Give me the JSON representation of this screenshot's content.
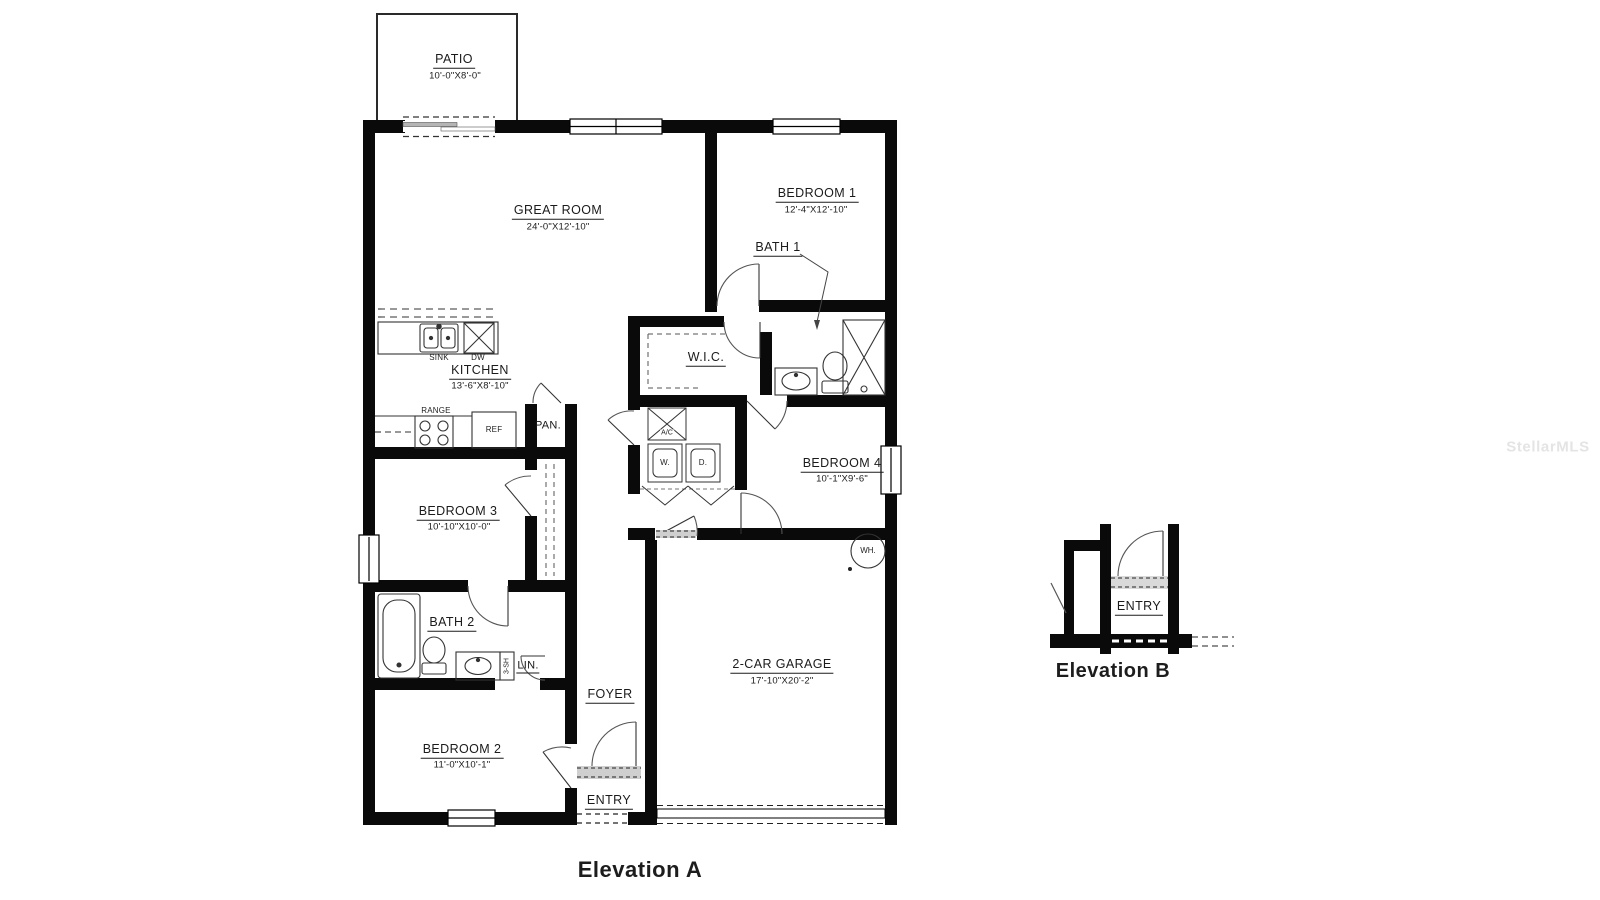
{
  "plan": {
    "watermark": "StellarMLS",
    "titles": {
      "elevation_a": "Elevation A",
      "elevation_b": "Elevation B"
    },
    "rooms": {
      "patio": {
        "name": "PATIO",
        "dims": "10'-0\"X8'-0\""
      },
      "great_room": {
        "name": "GREAT ROOM",
        "dims": "24'-0\"X12'-10\""
      },
      "bedroom1": {
        "name": "BEDROOM 1",
        "dims": "12'-4\"X12'-10\""
      },
      "bath1": {
        "name": "BATH 1"
      },
      "kitchen": {
        "name": "KITCHEN",
        "dims": "13'-6\"X8'-10\""
      },
      "wic": {
        "name": "W.I.C."
      },
      "bedroom4": {
        "name": "BEDROOM 4",
        "dims": "10'-1\"X9'-6\""
      },
      "bedroom3": {
        "name": "BEDROOM 3",
        "dims": "10'-10\"X10'-0\""
      },
      "bath2": {
        "name": "BATH 2"
      },
      "bedroom2": {
        "name": "BEDROOM 2",
        "dims": "11'-0\"X10'-1\""
      },
      "foyer": {
        "name": "FOYER"
      },
      "entry": {
        "name": "ENTRY"
      },
      "garage": {
        "name": "2-CAR GARAGE",
        "dims": "17'-10\"X20'-2\""
      },
      "entry_b": {
        "name": "ENTRY"
      }
    },
    "fixtures": {
      "sink": "SINK",
      "dw": "DW",
      "range": "RANGE",
      "ref": "REF",
      "pantry": "PAN.",
      "ac": "A/C",
      "washer": "W.",
      "dryer": "D.",
      "water_heater": "WH.",
      "linen": "LIN.",
      "shelves": "3-SH"
    }
  }
}
